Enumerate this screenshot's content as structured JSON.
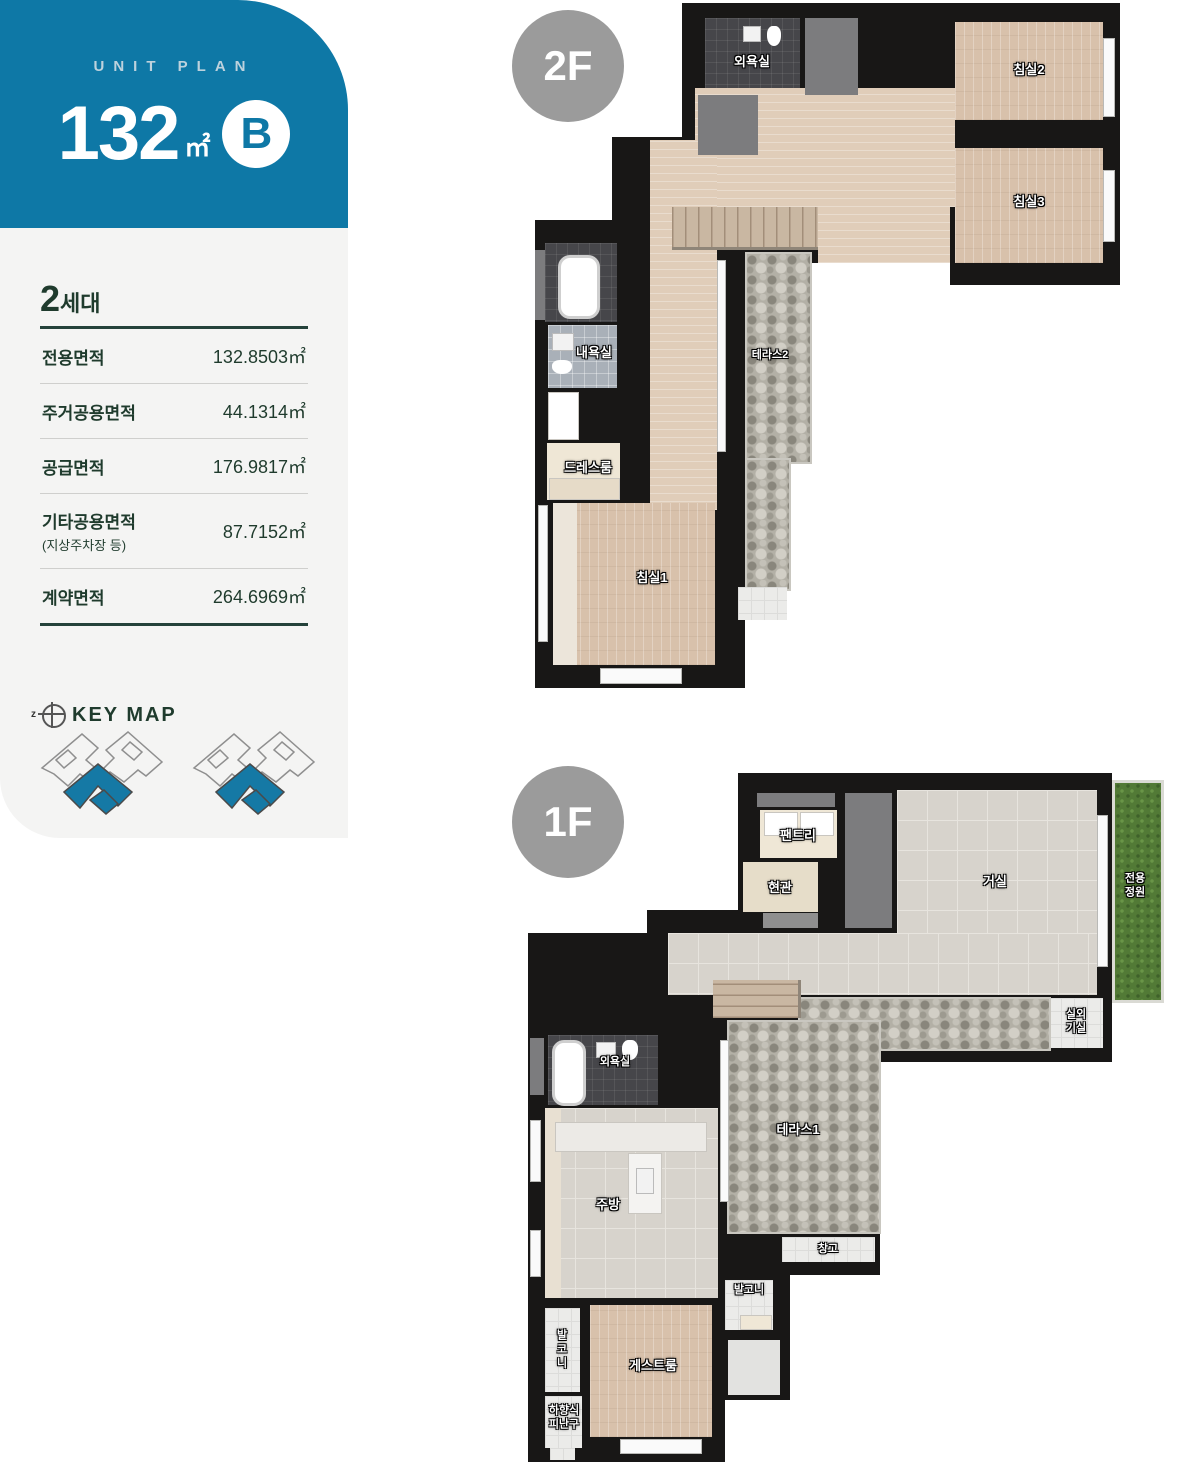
{
  "sidebar": {
    "eyebrow": "UNIT PLAN",
    "unit_number": "132",
    "unit_suffix": "㎡",
    "unit_type": "B",
    "accent_color": "#0e78a6",
    "text_color": "#1f3b2d",
    "household": {
      "number": "2",
      "suffix": "세대"
    },
    "area_table": [
      {
        "label": "전용면적",
        "value": "132.8503㎡"
      },
      {
        "label": "주거공용면적",
        "value": "44.1314㎡"
      },
      {
        "label": "공급면적",
        "value": "176.9817㎡"
      },
      {
        "label": "기타공용면적",
        "sublabel": "(지상주차장 등)",
        "value": "87.7152㎡"
      },
      {
        "label": "계약면적",
        "value": "264.6969㎡"
      }
    ],
    "keymap": {
      "compass_letter": "z",
      "title": "KEY MAP"
    }
  },
  "floor2": {
    "badge": "2F",
    "badge_color": "#9b9b9b",
    "rooms": {
      "bath_outer": "외욕실",
      "bedroom2": "침실2",
      "bedroom3": "침실3",
      "bath_inner": "내욕실",
      "terrace2": "테라스2",
      "dressroom": "드레스룸",
      "bedroom1": "침실1"
    }
  },
  "floor1": {
    "badge": "1F",
    "badge_color": "#9b9b9b",
    "rooms": {
      "pantry": "팬트리",
      "entrance": "현관",
      "living": "거실",
      "private_garden": "전용\n정원",
      "outdoor_unit": "실외\n기실",
      "bath_outer": "외욕실",
      "kitchen": "주방",
      "terrace1": "테라스1",
      "storage": "창고",
      "balcony_right": "발코니",
      "balcony_left": "발\n코\n니",
      "guestroom": "게스트룸",
      "escape_hatch": "하향식\n피난구"
    }
  }
}
